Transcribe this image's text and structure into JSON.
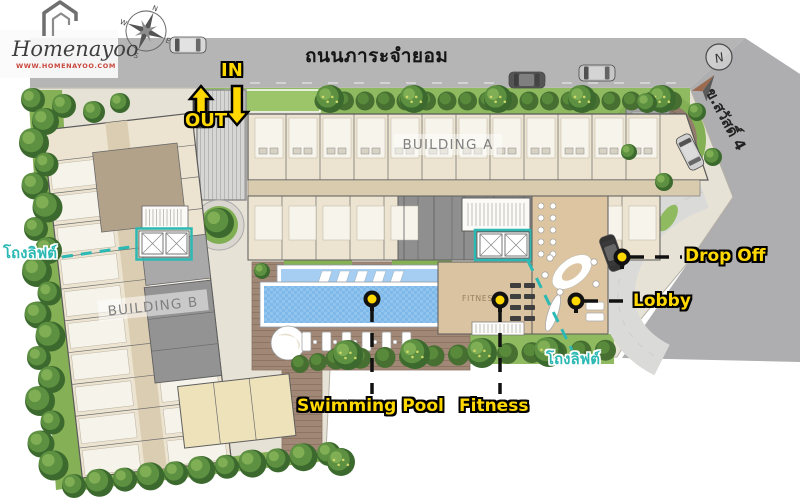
{
  "brand": {
    "name": "Homenayoo",
    "url": "WWW.HOMENAYOO.COM"
  },
  "roads": {
    "top": "ถนนภาระจำยอม",
    "side": "ข.สวัสดิ์ 4"
  },
  "traffic": {
    "in_label": "IN",
    "out_label": "OUT"
  },
  "buildings": {
    "a": "BUILDING A",
    "b": "BUILDING B"
  },
  "amenities": {
    "drop_off": "Drop Off",
    "lobby": "Lobby",
    "swimming_pool": "Swimming Pool",
    "fitness": "Fitness",
    "fitness_room": "FITNESS",
    "lift_hall_left": "โถงลิฟต์",
    "lift_hall_right": "โถงลิฟต์"
  },
  "compass": {
    "n": "N",
    "e": "E",
    "s": "S",
    "w": "W"
  },
  "colors": {
    "label_yellow": "#ffd800",
    "label_cyan": "#2cb9b4",
    "road_gray": "#b5b5b6",
    "pool_blue": "#7fb9e9",
    "grass_green": "#8fba60",
    "deck_brown": "#a18876",
    "building_cream": "#ece4d0",
    "logo_red": "#c9473d"
  }
}
